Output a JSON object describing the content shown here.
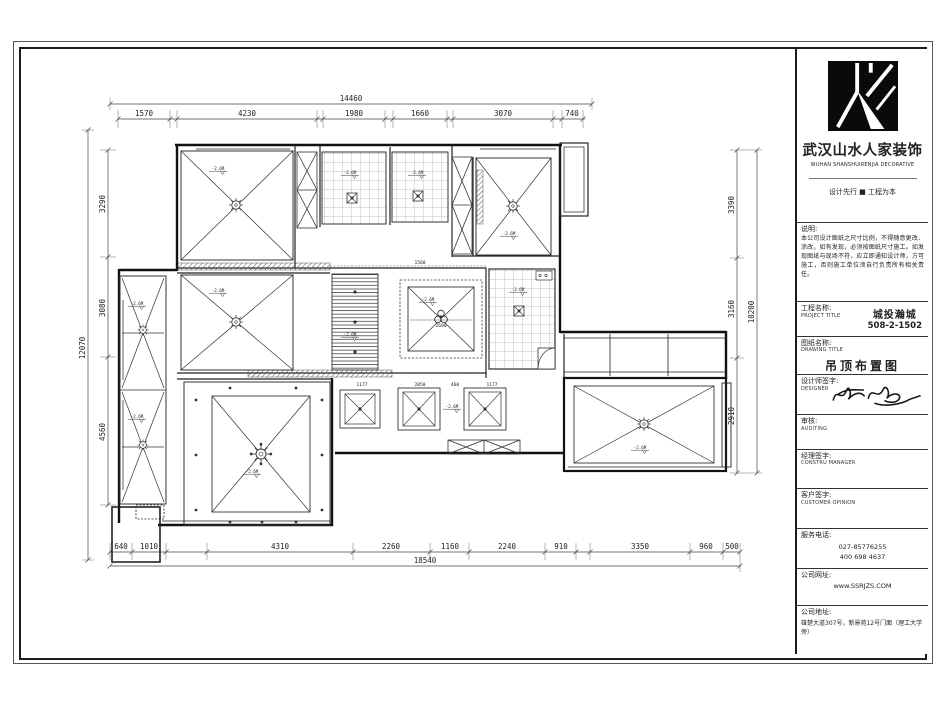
{
  "title_block": {
    "company_cn": "武汉山水人家装饰",
    "company_en": "WUHAN SHANSHUIRENJIA DECORATIVE",
    "slogan": "设计先行 ■ 工程为本",
    "notes_label": "说明:",
    "notes_text": "本公司设计图纸之尺寸比例，不得随意更改、涂改，如有发现，必须按图纸尺寸施工。如发现图纸与现场不符，应立即通知设计师，方可施工，否则施工单位须自行负责所有相关责任。",
    "project_label_cn": "工程名称:",
    "project_label_en": "PROJECT TITLE",
    "project_value_1": "城投瀚城",
    "project_value_2": "508-2-1502",
    "drawing_label_cn": "图纸名称:",
    "drawing_label_en": "DRAWING TITLE",
    "drawing_value": "吊顶布置图",
    "designer_label_cn": "设计师签字:",
    "designer_label_en": "DESIGNER",
    "audit_label_cn": "审核:",
    "audit_label_en": "AUDITING",
    "manager_label_cn": "经理签字:",
    "manager_label_en": "CONSTRU MANAGER",
    "customer_label_cn": "客户签字:",
    "customer_label_en": "CUSTOMER OPINION",
    "phone_label": "服务电话:",
    "phone_1": "027-85776255",
    "phone_2": "400 698 4637",
    "web_label": "公司网址:",
    "web_value": "www.SSRJZS.COM",
    "addr_label": "公司地址:",
    "addr_value": "雄楚大道307号，新景苑12号门面（理工大学旁）"
  },
  "plan": {
    "level_label": "-2.6M",
    "dims": {
      "top_total": "14460",
      "top": [
        "1570",
        "4230",
        "1980",
        "1660",
        "3070",
        "740"
      ],
      "bottom_total": "18540",
      "bottom": [
        "640",
        "1010",
        "4310",
        "2260",
        "1160",
        "2240",
        "910",
        "3350",
        "960",
        "500"
      ],
      "left_total": "12070",
      "left": [
        "3290",
        "3080",
        "4560"
      ],
      "right_total": "10200",
      "right": [
        "3390",
        "3160",
        "2910"
      ],
      "inner": [
        "2690",
        "1560",
        "1177",
        "2050",
        "460",
        "1177"
      ]
    }
  }
}
